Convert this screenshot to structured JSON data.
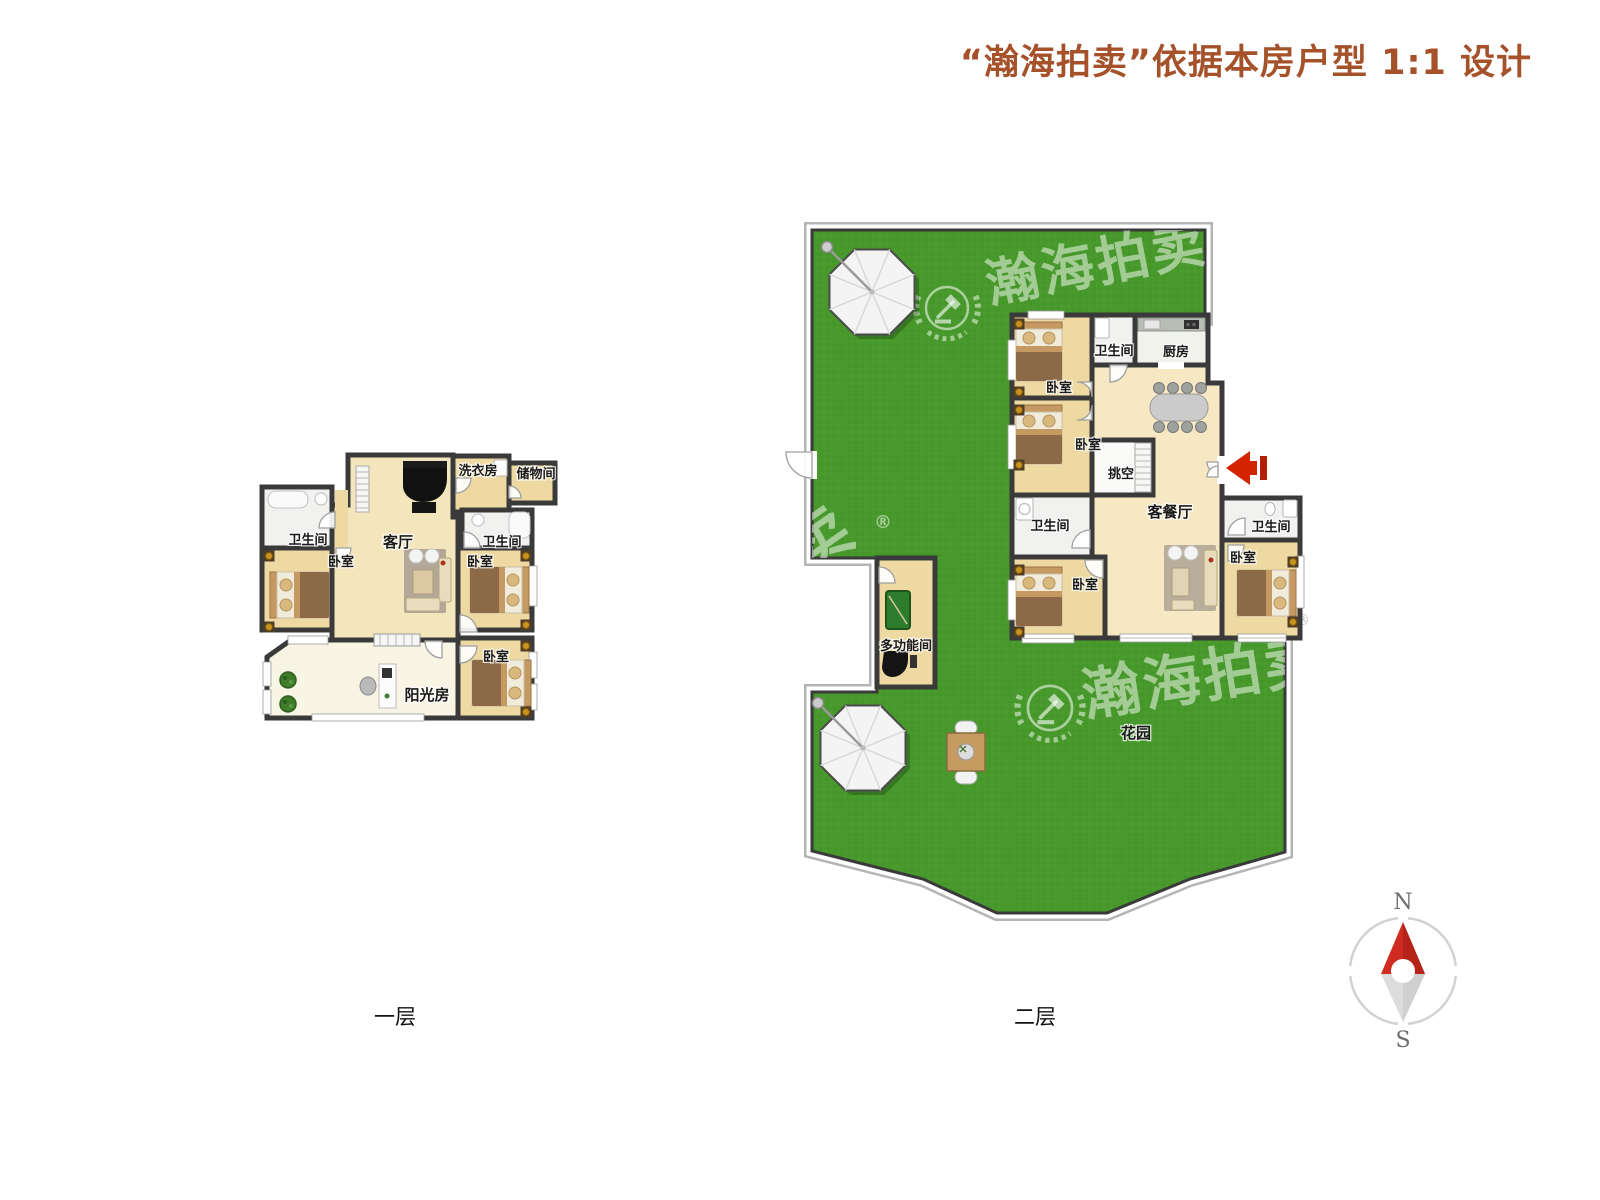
{
  "title": "“瀚海拍卖”依据本房户型 1:1 设计",
  "floor1": {
    "name": "一层",
    "rooms": {
      "bath_left": "卫生间",
      "bedroom_left": "卧室",
      "living": "客厅",
      "laundry": "洗衣房",
      "storage": "储物间",
      "bath_right": "卫生间",
      "bedroom_right": "卧室",
      "bedroom_bottom": "卧室",
      "sunroom": "阳光房"
    }
  },
  "floor2": {
    "name": "二层",
    "rooms": {
      "bedroom_top": "卧室",
      "bath_top": "卫生间",
      "kitchen": "厨房",
      "bedroom_mid": "卧室",
      "void": "挑空",
      "bath_mid": "卫生间",
      "bedroom_bottom": "卧室",
      "living_dining": "客餐厅",
      "bath_right": "卫生间",
      "bedroom_right": "卧室",
      "multi_function": "多功能间",
      "garden": "花园"
    }
  },
  "watermark": {
    "brand": "瀚海拍卖",
    "registered": "®"
  },
  "compass": {
    "north": "N",
    "south": "S"
  },
  "colors": {
    "title_accent": "#a5512a",
    "garden_green": "#47992b",
    "wall": "#3a3a3a",
    "floor_tan": "#eed9a2",
    "arrow_red": "#d42300"
  }
}
